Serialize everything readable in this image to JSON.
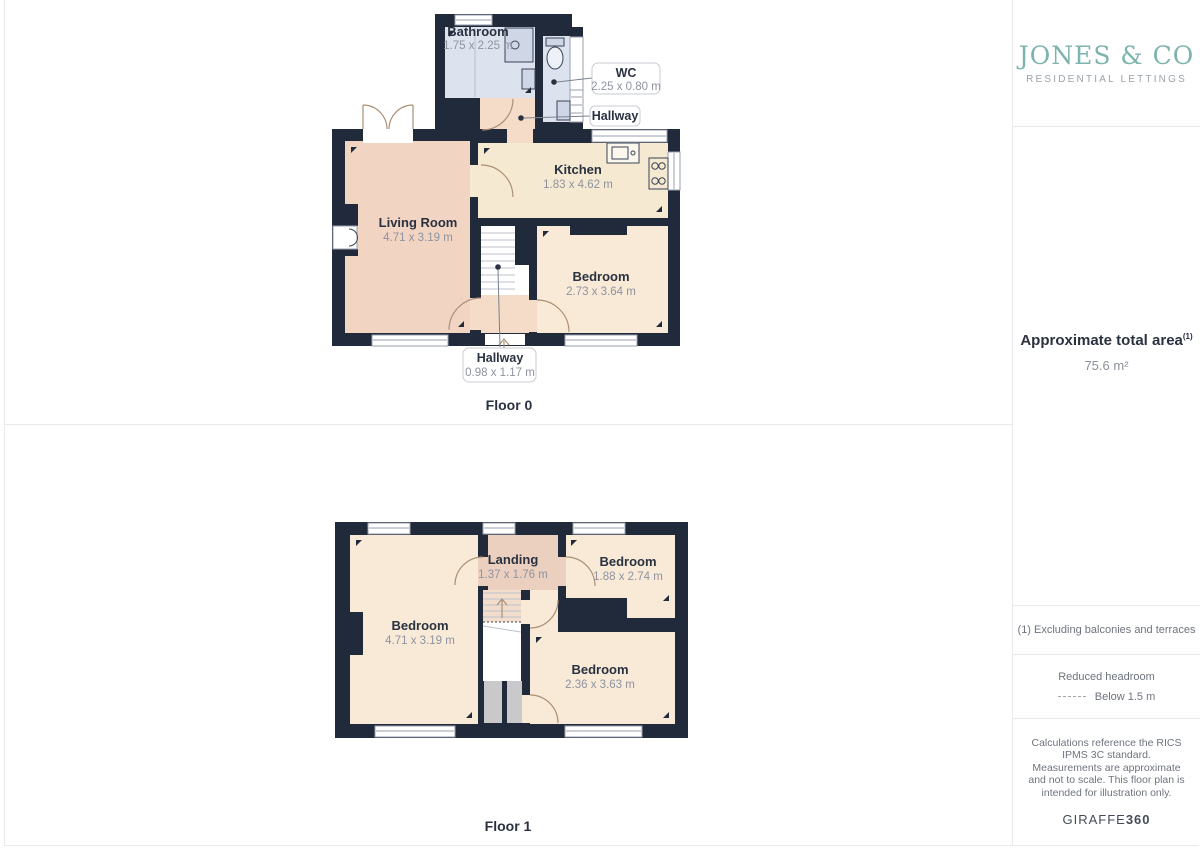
{
  "brand": {
    "name": "JONES & CO",
    "tagline": "RESIDENTIAL LETTINGS",
    "accent": "#7db4ae"
  },
  "sidebar": {
    "area_title": "Approximate total area",
    "area_sup": "(1)",
    "area_value": "75.6 m²",
    "footnote": "(1) Excluding balconies and terraces",
    "headroom_title": "Reduced headroom",
    "headroom_value": "Below 1.5 m",
    "disclaimer": "Calculations reference the RICS IPMS 3C standard. Measurements are approximate and not to scale. This floor plan is intended for illustration only.",
    "credit_name": "GIRAFFE",
    "credit_suffix": "360"
  },
  "floors": [
    {
      "label": "Floor 0",
      "rooms": [
        {
          "name": "Bathroom",
          "dims": "1.75 x 2.25 m"
        },
        {
          "name": "WC",
          "dims": "2.25 x 0.80 m"
        },
        {
          "name": "Hallway",
          "dims": ""
        },
        {
          "name": "Kitchen",
          "dims": "1.83 x 4.62 m"
        },
        {
          "name": "Living Room",
          "dims": "4.71 x 3.19 m"
        },
        {
          "name": "Bedroom",
          "dims": "2.73 x 3.64 m"
        },
        {
          "name": "Hallway",
          "dims": "0.98 x 1.17 m"
        }
      ]
    },
    {
      "label": "Floor 1",
      "rooms": [
        {
          "name": "Landing",
          "dims": "1.37 x 1.76 m"
        },
        {
          "name": "Bedroom",
          "dims": "1.88 x 2.74 m"
        },
        {
          "name": "Bedroom",
          "dims": "4.71 x 3.19 m"
        },
        {
          "name": "Bedroom",
          "dims": "2.36 x 3.63 m"
        }
      ]
    }
  ],
  "colors": {
    "wall": "#212a3b",
    "bathroom": "#dde3ee",
    "living_room": "#f2d4c2",
    "kitchen": "#f6e9d1",
    "bedroom": "#f8ead6",
    "hallway": "#f4dcc8",
    "landing": "#ecd0bf",
    "closet": "#c9c9cc",
    "brand_teal": "#7db4ae"
  }
}
